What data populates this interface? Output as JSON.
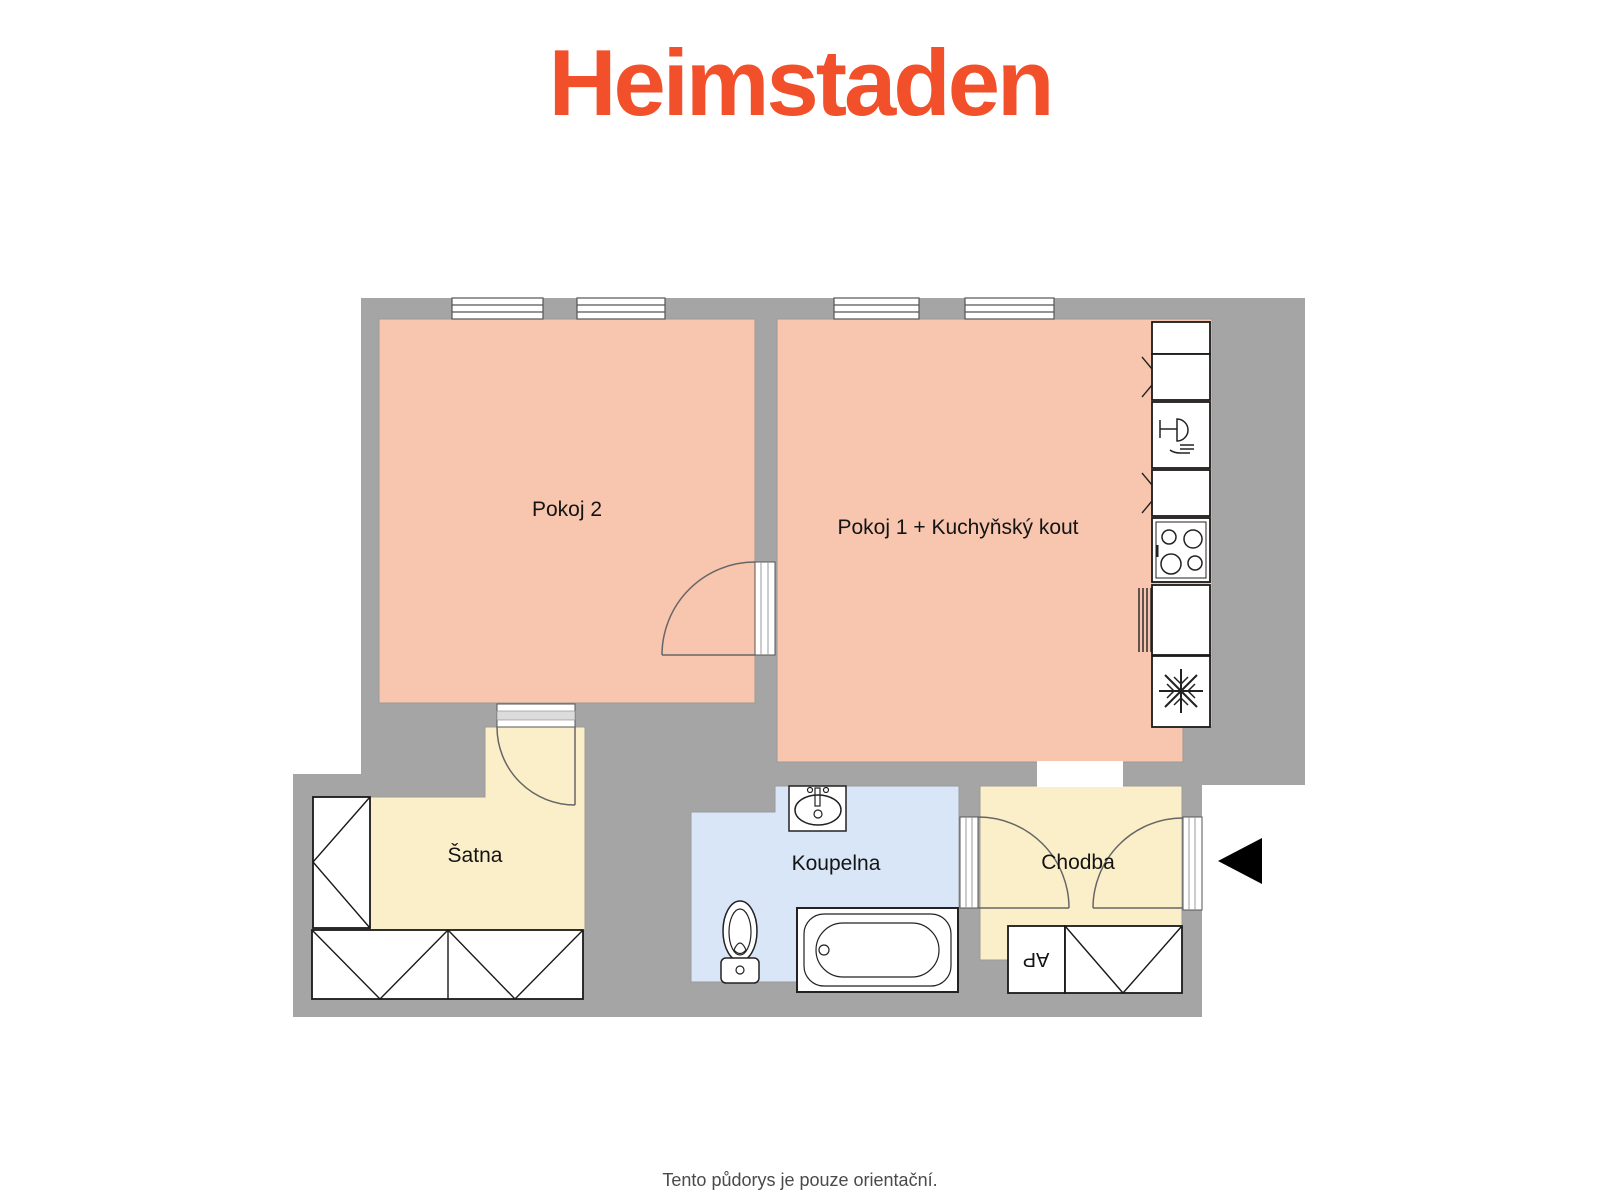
{
  "header": {
    "logo_text": "Heimstaden",
    "logo_color": "#F2502A"
  },
  "floorplan": {
    "wall_color": "#A5A5A5",
    "arrow_color": "#000000",
    "rooms": {
      "pokoj2": {
        "label": "Pokoj 2",
        "color": "#F8C5AE"
      },
      "pokoj1": {
        "label": "Pokoj 1 + Kuchyňský kout",
        "color": "#F8C5AE"
      },
      "satna": {
        "label": "Šatna",
        "color": "#FBEFC9"
      },
      "koupelna": {
        "label": "Koupelna",
        "color": "#D9E6F8"
      },
      "chodba": {
        "label": "Chodba",
        "color": "#FBEFC9"
      }
    },
    "fixtures": {
      "ap_cabinet_label": "AP",
      "kitchen_column": [
        "cabinet",
        "corner-cabinet",
        "dishwasher",
        "corner-cabinet",
        "stove",
        "cabinet",
        "freezer"
      ],
      "bathroom": [
        "sink",
        "toilet",
        "bathtub"
      ],
      "wardrobes": [
        "satna-left",
        "satna-bottom-1",
        "satna-bottom-2",
        "chodba-wardrobe"
      ],
      "entrance_arrow_direction": "left"
    }
  },
  "footer": {
    "disclaimer": "Tento půdorys je pouze orientační.",
    "color": "#4A4A4A"
  }
}
